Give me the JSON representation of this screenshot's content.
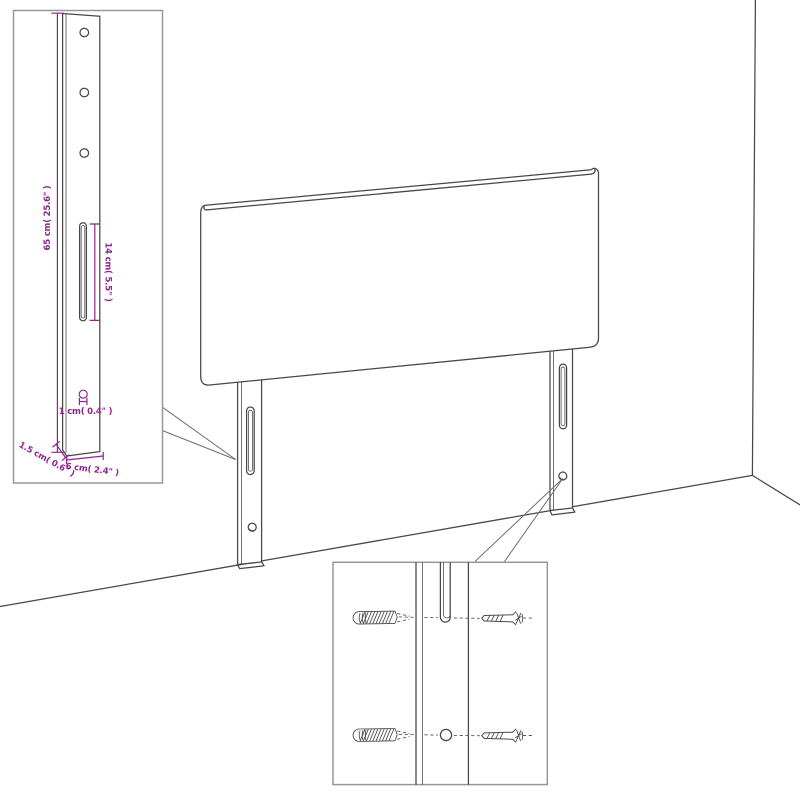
{
  "title": "Headboard wall-mounting technical diagram",
  "colors": {
    "drawing_line": "#474747",
    "dimension_magenta": "#8e2490",
    "inset_border": "#979797",
    "background": "#ffffff"
  },
  "labels": {
    "leg_height": "65 cm( 25.6\" )",
    "slot_length": "14 cm( 5.5\" )",
    "hole_diameter": "1 cm( 0.4\" )",
    "leg_thickness": "1.5 cm( 0.6\" )",
    "leg_width": "6 cm( 2.4\" )"
  }
}
